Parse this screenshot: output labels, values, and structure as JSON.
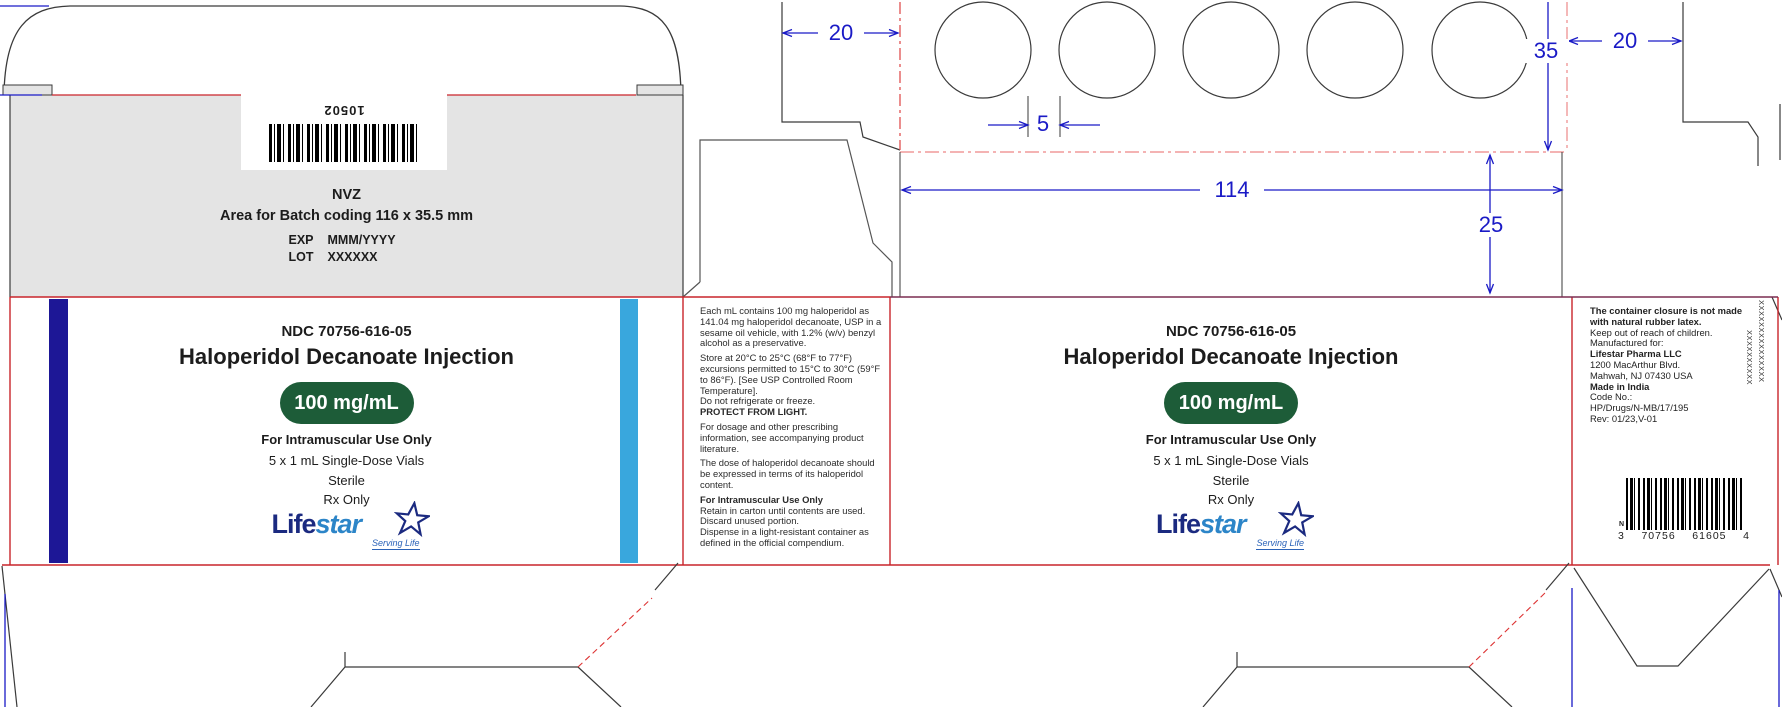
{
  "batch_panel": {
    "barcode_number": "10502",
    "code": "NVZ",
    "area_note": "Area for Batch coding 116 x 35.5 mm",
    "exp_label": "EXP",
    "exp_value": "MMM/YYYY",
    "lot_label": "LOT",
    "lot_value": "XXXXXX"
  },
  "main_panel": {
    "ndc": "NDC 70756-616-05",
    "title": "Haloperidol Decanoate Injection",
    "strength": "100 mg/mL",
    "route": "For Intramuscular Use Only",
    "pack": "5 x 1 mL Single-Dose Vials",
    "sterile": "Sterile",
    "rx": "Rx Only",
    "logo_life": "Life",
    "logo_star": "star",
    "logo_tagline": "Serving Life"
  },
  "side_panel": {
    "paragraphs": [
      "Each mL contains 100 mg haloperidol as 141.04 mg haloperidol decanoate, USP in a sesame oil vehicle, with 1.2% (w/v) benzyl alcohol as a preservative.",
      "Store at 20°C to 25°C (68°F to 77°F) excursions permitted to 15°C to 30°C (59°F to 86°F). [See USP Controlled Room Temperature].",
      "Do not refrigerate or freeze.",
      "PROTECT FROM LIGHT.",
      "For dosage and other prescribing information, see accompanying product literature.",
      "The dose of haloperidol decanoate should be expressed in terms of its haloperidol content.",
      "For Intramuscular Use Only",
      "Retain in carton until contents are used. Discard unused portion.",
      "Dispense in a light-resistant container as defined in the official compendium."
    ]
  },
  "info_panel": {
    "latex_note": "The container closure is not made with natural rubber latex.",
    "children_note": "Keep out of reach of children.",
    "mfr_label": "Manufactured for:",
    "mfr_name": "Lifestar Pharma LLC",
    "addr1": "1200 MacArthur Blvd.",
    "addr2": "Mahwah, NJ 07430 USA",
    "origin": "Made in India",
    "code_label": "Code No.:",
    "code_value": "HP/Drugs/N-MB/17/195",
    "rev": "Rev: 01/23,V-01",
    "barcode_n": "N",
    "barcode_d1": "3",
    "barcode_d2": "70756",
    "barcode_d3": "61605",
    "barcode_d4": "4",
    "serial_x1": "XXXXXXXXXXXXXXX",
    "serial_x2": "XXXXXXXXXX"
  },
  "dimensions": {
    "d20_left": "20",
    "d5": "5",
    "d35": "35",
    "d20_right": "20",
    "d114": "114",
    "d25": "25"
  },
  "colors": {
    "dieline_red": "#c9252b",
    "dieline_pink": "#f09a9a",
    "dieline_maroon": "#7c2d50",
    "dimension_blue": "#1a1ac6",
    "stripe_navy": "#1d1796",
    "stripe_sky": "#39a7dd",
    "pill_green": "#1d5c38",
    "gray_panel": "#e4e4e4",
    "logo_navy": "#1b2a80",
    "logo_blue": "#2c85c8"
  }
}
